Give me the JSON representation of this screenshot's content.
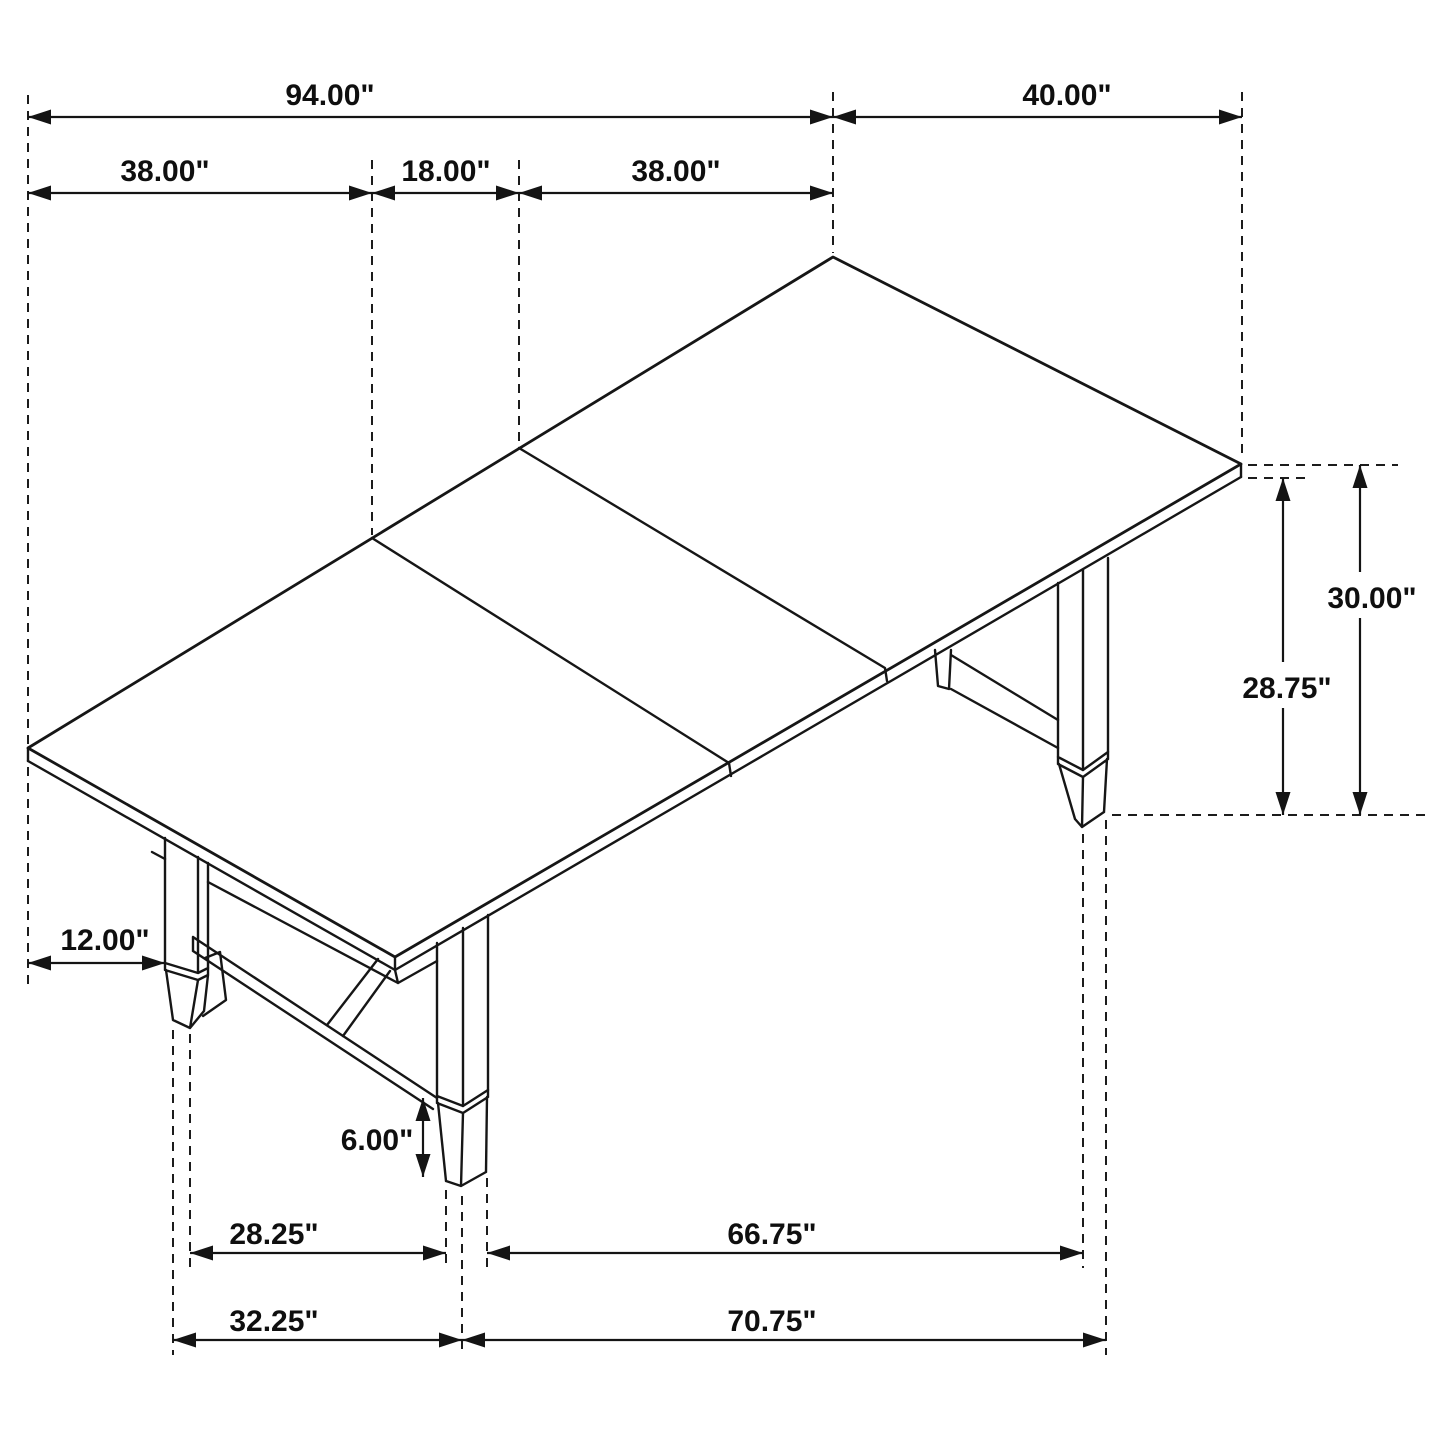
{
  "diagram": {
    "type": "furniture-dimension-drawing",
    "subject": "extendable trestle dining table isometric line drawing",
    "background_color": "#ffffff",
    "line_color": "#161616",
    "unit": "inches"
  },
  "dimensions": [
    {
      "name": "overall-length",
      "label": "94.00\""
    },
    {
      "name": "table-width",
      "label": "40.00\""
    },
    {
      "name": "end-section-length",
      "label": "38.00\""
    },
    {
      "name": "leaf-length",
      "label": "18.00\""
    },
    {
      "name": "end-section-length-2",
      "label": "38.00\""
    },
    {
      "name": "table-height",
      "label": "30.00\""
    },
    {
      "name": "apron-clearance-height",
      "label": "28.75\""
    },
    {
      "name": "leg-inset-from-end",
      "label": "12.00\""
    },
    {
      "name": "foot-height",
      "label": "6.00\""
    },
    {
      "name": "leg-span-inner",
      "label": "28.25\""
    },
    {
      "name": "leg-span-long-inner",
      "label": "66.75\""
    },
    {
      "name": "base-end-span",
      "label": "32.25\""
    },
    {
      "name": "base-long-span",
      "label": "70.75\""
    }
  ]
}
